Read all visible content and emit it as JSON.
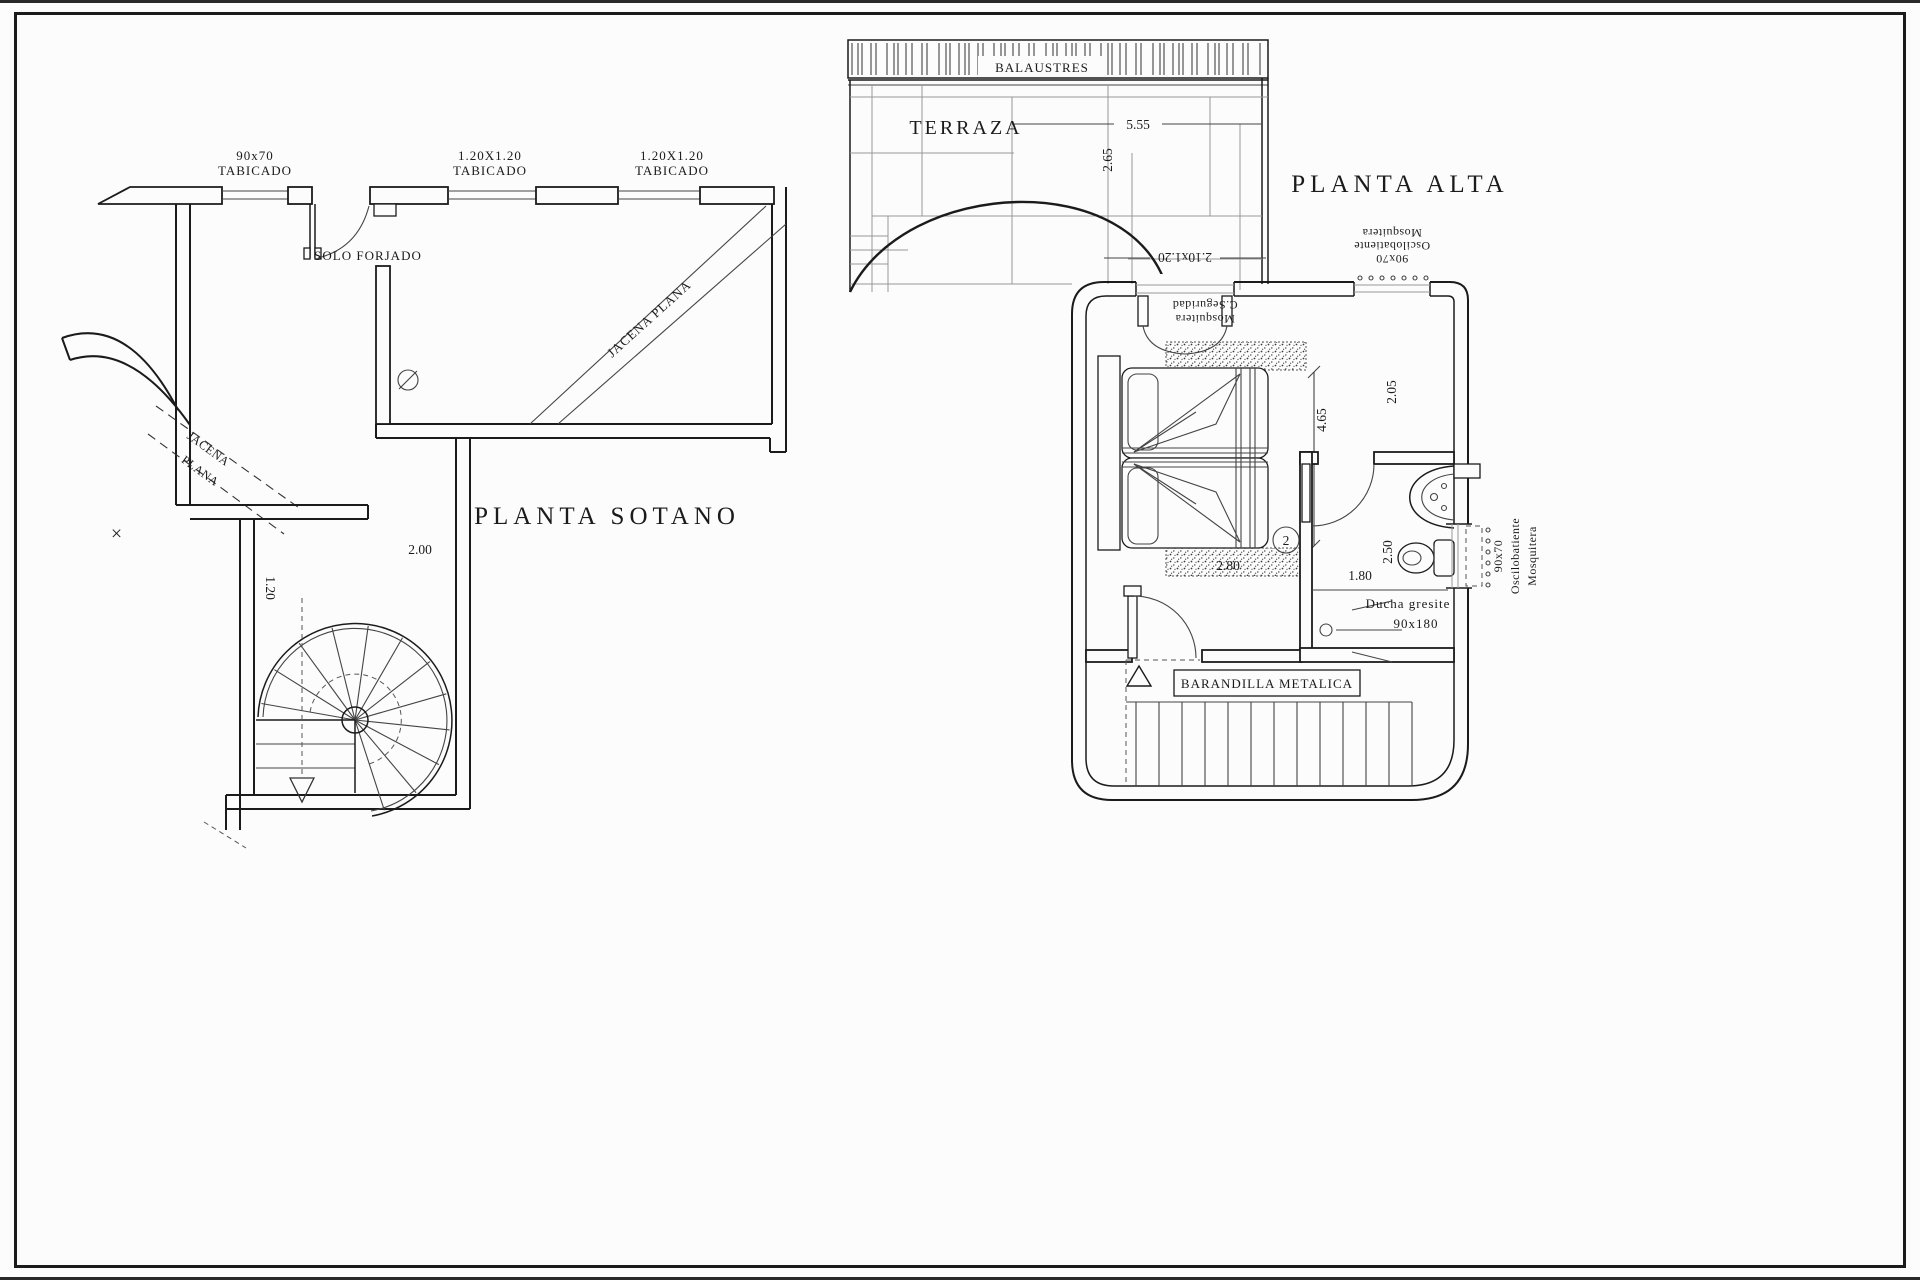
{
  "sheet": {
    "bg": "#fcfcfc",
    "ink": "#1b1b1b"
  },
  "sotano": {
    "title": "PLANTA  SOTANO",
    "window1_size": "90x70",
    "window1_type": "TABICADO",
    "window2_size": "1.20X1.20",
    "window2_type": "TABICADO",
    "window3_size": "1.20X1.20",
    "window3_type": "TABICADO",
    "solo_forjado": "SOLO FORJADO",
    "jacena_wall_1": "JACENA",
    "jacena_wall_2": "PLANA",
    "jacena_beam": "JACENA PLANA",
    "dim_stair_width": "2.00",
    "dim_stair_corridor": "1.20",
    "section_mark": "×"
  },
  "alta": {
    "title": "PLANTA  ALTA",
    "balaustres": "BALAUSTRES",
    "terraza": "TERRAZA",
    "dim_terrace_width": "5.55",
    "dim_terrace_depth": "2.65",
    "door_dim": "2.10x1.20",
    "door_screen_1": "Mosquitera",
    "door_screen_2": "C.Seguridad",
    "window_top_size": "90x70",
    "window_top_type": "Oscilobatiente",
    "window_top_screen": "Mosquitera",
    "dim_bed_length": "4.65",
    "dim_bed_width": "2.80",
    "dim_room": "2.05",
    "room_number": "2",
    "dim_wc": "2.50",
    "dim_wc_width": "1.80",
    "shower_label_1": "Ducha gresite",
    "shower_label_2": "90x180",
    "window_right_size": "90x70",
    "window_right_type": "Oscilobatiente",
    "window_right_screen": "Mosquitera",
    "barandilla": "BARANDILLA METALICA"
  }
}
